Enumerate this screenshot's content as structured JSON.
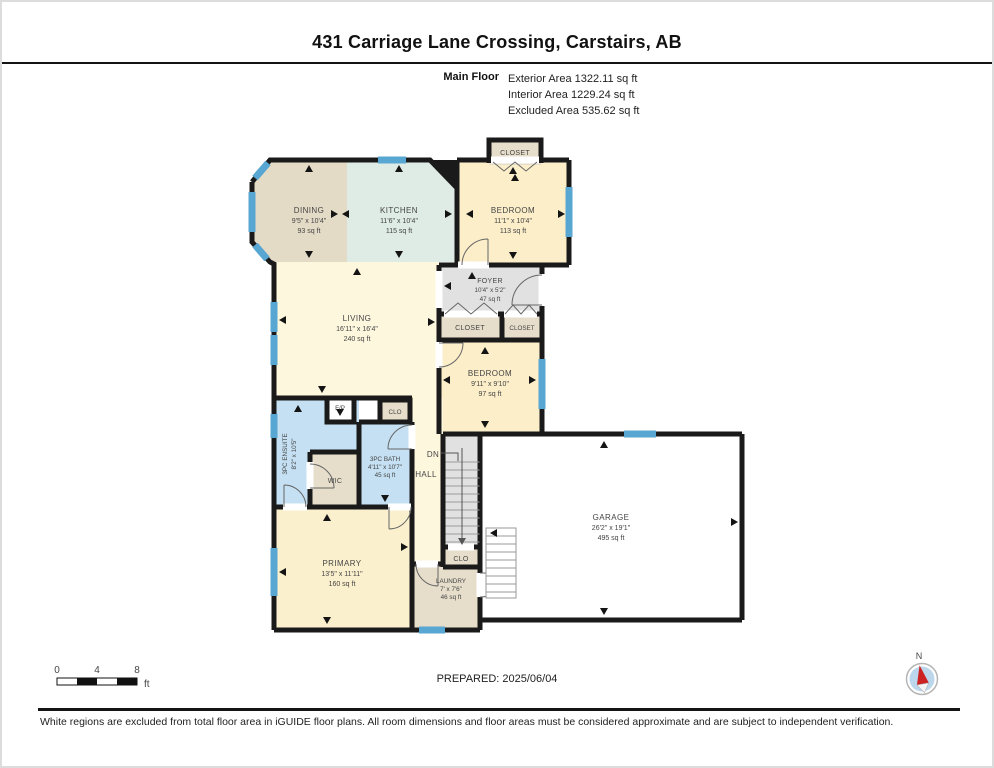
{
  "header": {
    "title": "431 Carriage Lane Crossing, Carstairs, AB",
    "floor_label": "Main Floor",
    "stats": [
      "Exterior Area 1322.11 sq ft",
      "Interior Area 1229.24 sq ft",
      "Excluded Area 535.62 sq ft"
    ]
  },
  "rooms": {
    "dining": {
      "name": "DINING",
      "dims": "9'5\" x 10'4\"",
      "area": "93 sq ft"
    },
    "kitchen": {
      "name": "KITCHEN",
      "dims": "11'6\" x 10'4\"",
      "area": "115 sq ft"
    },
    "bedroom1": {
      "name": "BEDROOM",
      "dims": "11'1\" x 10'4\"",
      "area": "113 sq ft"
    },
    "closet_top": {
      "name": "CLOSET"
    },
    "foyer": {
      "name": "FOYER",
      "dims": "10'4\" x 5'2\"",
      "area": "47 sq ft"
    },
    "closet_a": {
      "name": "CLOSET"
    },
    "closet_b": {
      "name": "CLOSET"
    },
    "living": {
      "name": "LIVING",
      "dims": "16'11\" x 16'4\"",
      "area": "240 sq ft"
    },
    "bedroom2": {
      "name": "BEDROOM",
      "dims": "9'11\" x 9'10\"",
      "area": "97 sq ft"
    },
    "fireplace": {
      "name": "F/P"
    },
    "clo_upper": {
      "name": "CLO"
    },
    "ensuite": {
      "name": "3PC ENSUITE",
      "dims": "8'2\" x 10'5\""
    },
    "wic": {
      "name": "WIC"
    },
    "bath": {
      "name": "3PC BATH",
      "dims": "4'11\" x 10'7\"",
      "area": "45 sq ft"
    },
    "hall": {
      "name": "HALL"
    },
    "stairs": {
      "name": "DN"
    },
    "garage": {
      "name": "GARAGE",
      "dims": "26'2\" x 19'1\"",
      "area": "495 sq ft"
    },
    "primary": {
      "name": "PRIMARY",
      "dims": "13'5\" x 11'11\"",
      "area": "160 sq ft"
    },
    "clo_lower": {
      "name": "CLO"
    },
    "laundry": {
      "name": "LAUNDRY",
      "dims": "7' x 7'6\"",
      "area": "46 sq ft"
    }
  },
  "footer": {
    "scale": {
      "t0": "0",
      "t4": "4",
      "t8": "8",
      "unit": "ft"
    },
    "prepared": "PREPARED: 2025/06/04",
    "compass_n": "N",
    "disclaimer": "White regions are excluded from total floor area in iGUIDE floor plans. All room dimensions and floor areas must be considered approximate and are subject to independent verification."
  },
  "colors": {
    "wall": "#1a1a1a",
    "window": "#58a6d2",
    "cream": "#fbeec9",
    "cream_light": "#fdf7de",
    "tan": "#e6decb",
    "dining": "#e4dbc7",
    "kitchen": "#dfece6",
    "gray": "#e1e1e1",
    "blue": "#c4e0f2",
    "white": "#ffffff",
    "primary": "#fbf0cd",
    "compass_red": "#cc2222",
    "compass_fill": "#bcd6ec"
  }
}
